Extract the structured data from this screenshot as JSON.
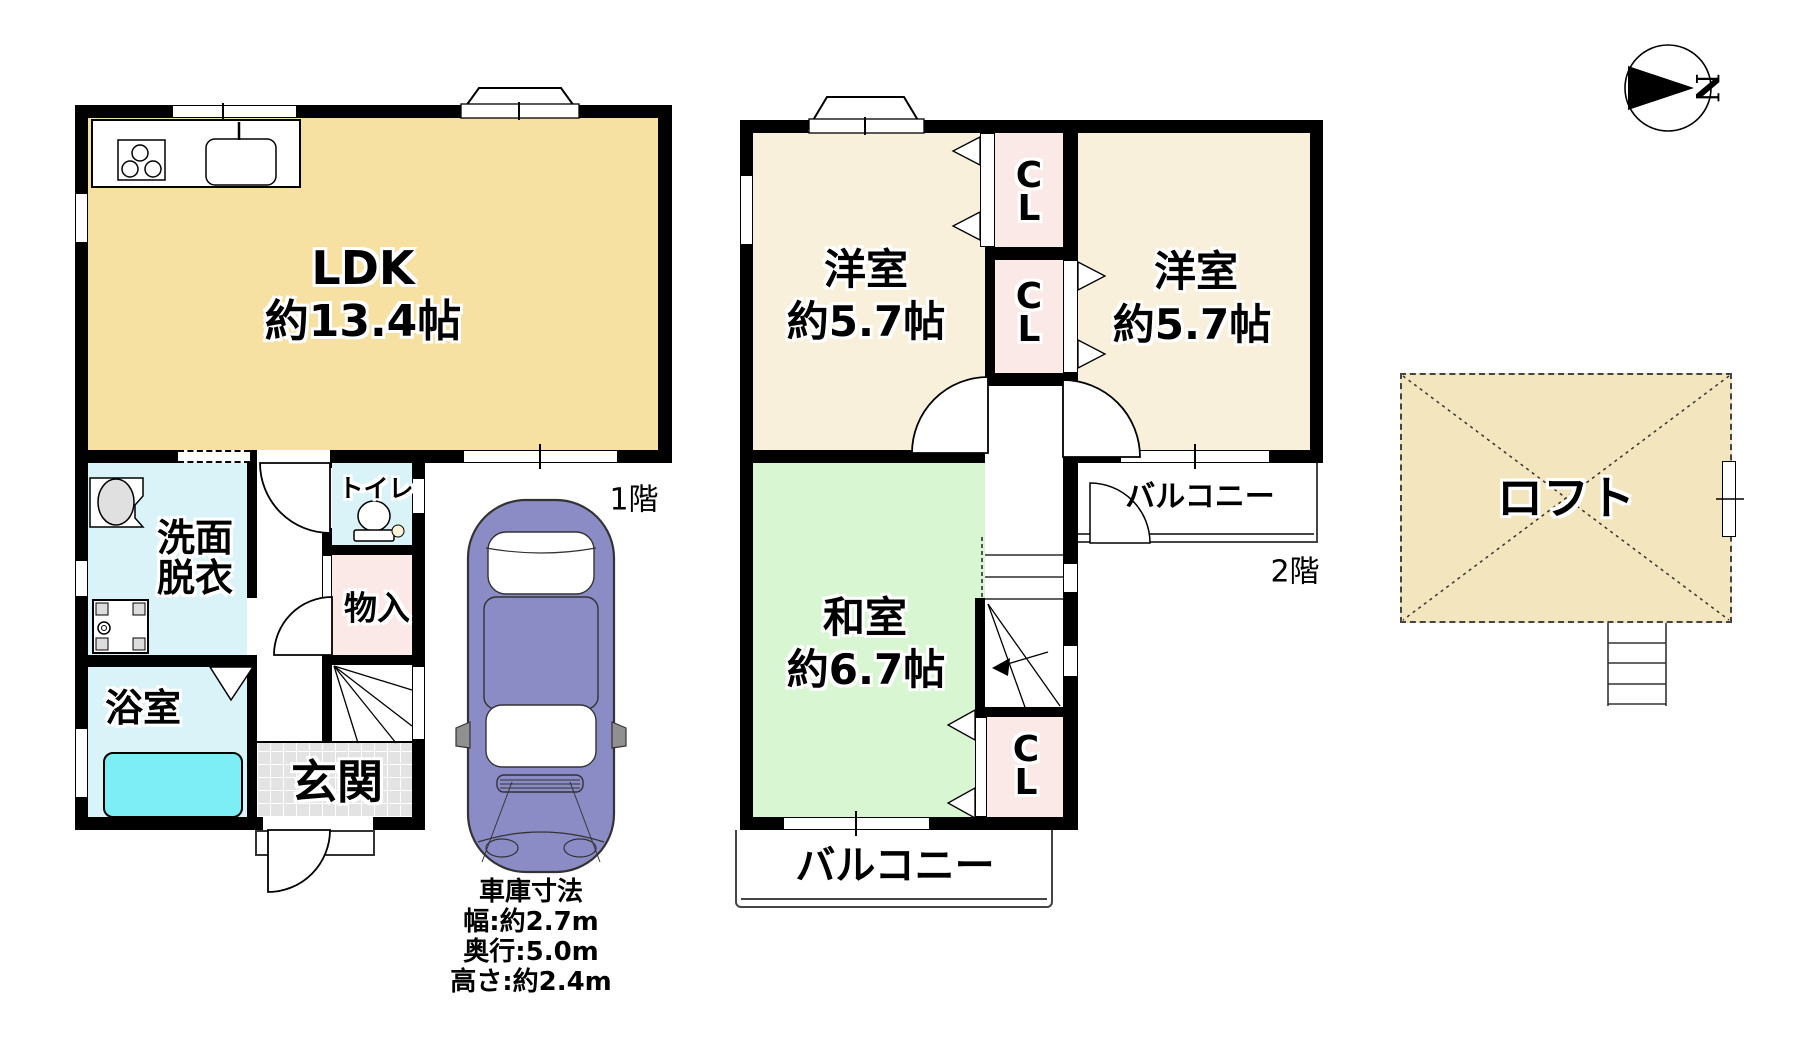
{
  "title": "floor-plan",
  "compass": {
    "north_label": "N"
  },
  "floor1": {
    "label": "1階",
    "ldk": {
      "name": "LDK",
      "size": "約13.4帖"
    },
    "washroom": {
      "line1": "洗面",
      "line2": "脱衣"
    },
    "toilet": "トイレ",
    "storage": "物入",
    "bathroom": "浴室",
    "entrance": "玄関",
    "garage": {
      "title": "車庫寸法",
      "width": "幅:約2.7m",
      "depth": "奥行:5.0m",
      "height": "高さ:約2.4m"
    }
  },
  "floor2": {
    "label": "2階",
    "western_room_left": {
      "name": "洋室",
      "size": "約5.7帖"
    },
    "western_room_right": {
      "name": "洋室",
      "size": "約5.7帖"
    },
    "japanese_room": {
      "name": "和室",
      "size": "約6.7帖"
    },
    "closet1": "CL",
    "closet2": "CL",
    "closet3": "CL",
    "balcony_right": "バルコニー",
    "balcony_bottom": "バルコニー"
  },
  "loft": {
    "label": "ロフト"
  },
  "colors": {
    "ldk_fill": "#F6E0A2",
    "western_fill": "#F8F0DB",
    "japanese_fill": "#D9F6D2",
    "closet_fill": "#FBE9E8",
    "wet_area_fill": "#DAF3F8",
    "bathtub_fill": "#7EEEF6",
    "entrance_tile": "#E3E3E3",
    "car_body": "#8B8CC6",
    "loft_fill": "#F3E5BD",
    "wall": "#000000"
  }
}
